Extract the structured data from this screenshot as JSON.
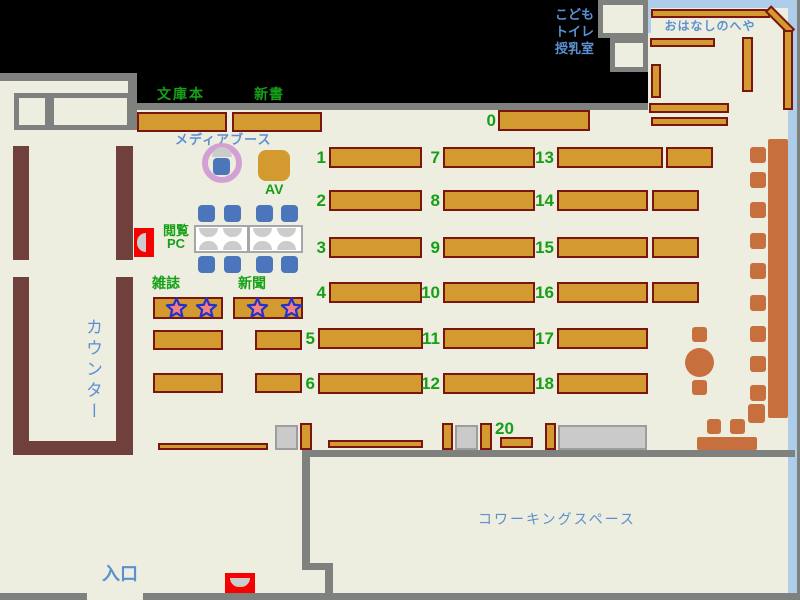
{
  "areas": {
    "kids": {
      "lines": [
        "こども",
        "トイレ",
        "授乳室"
      ]
    },
    "storytelling_room": "おはなしのへや",
    "counter": "カウンター",
    "entrance": "入口",
    "coworking": "コワーキングスペース"
  },
  "labels": {
    "bunkobon": "文庫本",
    "shinsho": "新書",
    "media_booth": "メディアブース",
    "av": "AV",
    "reading_pc": [
      "閲覧",
      "PC"
    ],
    "magazines": "雑誌",
    "newspapers": "新聞"
  },
  "shelf_numbers": {
    "top": "0",
    "grid": [
      [
        "1",
        "7",
        "13"
      ],
      [
        "2",
        "8",
        "14"
      ],
      [
        "3",
        "9",
        "15"
      ],
      [
        "4",
        "10",
        "16"
      ],
      [
        "5",
        "11",
        "17"
      ],
      [
        "6",
        "12",
        "18"
      ]
    ],
    "coworking_front": "20"
  },
  "colors": {
    "floor": "#EDEEDF",
    "outside": "#000000",
    "wall_gray": "#7E817E",
    "shelf_fill": "#D39B2F",
    "shelf_border": "#7B150F",
    "counter_brown": "#6F403C",
    "seat_terracotta": "#C8703D",
    "chair_blue": "#4B76BB",
    "window_blue": "#AECDEB",
    "text_green": "#16A016",
    "text_blue": "#5C90D2",
    "highlight_red": "#F70000",
    "media_ring": "#D2A0D2",
    "star_fill": "#F48080",
    "star_border": "#2233CC",
    "storage_gray": "#CACACA"
  }
}
